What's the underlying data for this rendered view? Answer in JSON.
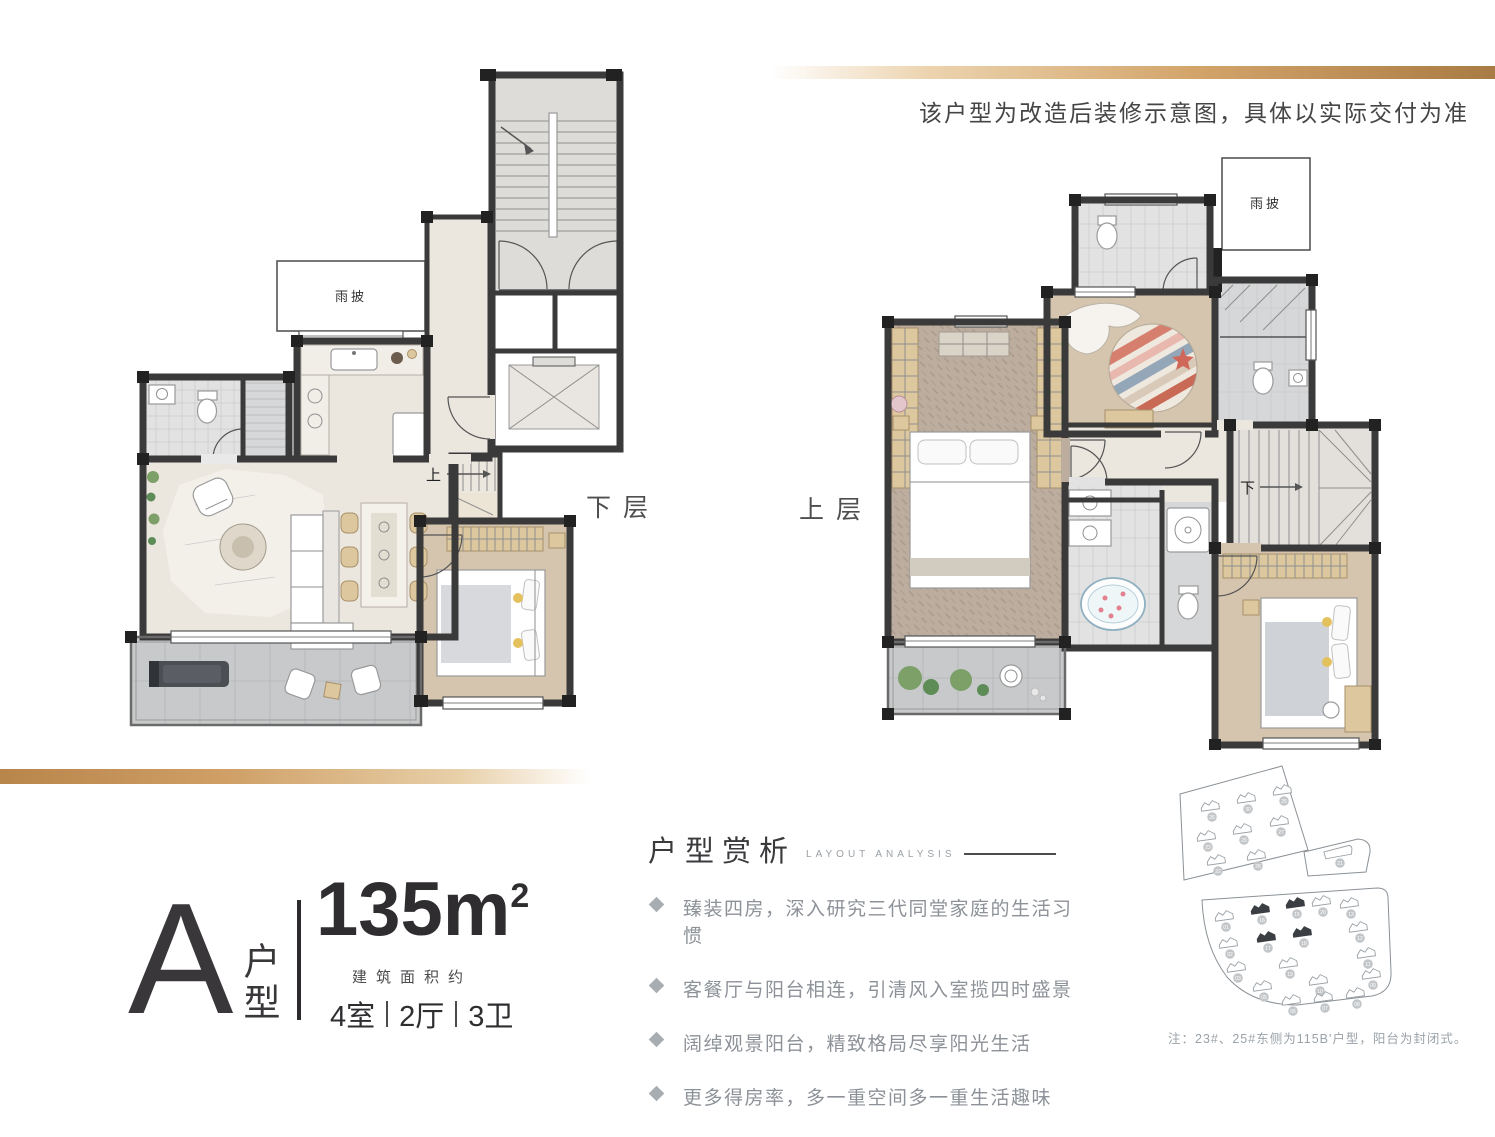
{
  "page": {
    "background": "#ffffff",
    "accent_gold": "#c9995f",
    "wall_color": "#3a3a3a"
  },
  "disclaimer": "该户型为改造后装修示意图，具体以实际交付为准",
  "plans": {
    "lower": {
      "label": "下层",
      "canopy_label": "雨披",
      "stair_label": "上"
    },
    "upper": {
      "label": "上层",
      "canopy_label": "雨披",
      "stair_label": "下"
    }
  },
  "spec": {
    "type_letter": "A",
    "type_name": "户型",
    "area_value": "135m",
    "area_sup": "2",
    "area_caption": "建筑面积约",
    "rooms": [
      "4室",
      "2厅",
      "3卫"
    ]
  },
  "analysis": {
    "title": "户型赏析",
    "subtitle": "LAYOUT ANALYSIS",
    "bullets": [
      "臻装四房，深入研究三代同堂家庭的生活习惯",
      "客餐厅与阳台相连，引清风入室揽四时盛景",
      "阔绰观景阳台，精致格局尽享阳光生活",
      "更多得房率，多一重空间多一重生活趣味"
    ]
  },
  "siteplan": {
    "note": "注：23#、25#东侧为115B'户型，阳台为封闭式。",
    "highlighted": [
      "15",
      "16",
      "17",
      "18"
    ],
    "upper_buildings": [
      "26",
      "30",
      "25",
      "23",
      "29",
      "27",
      "22",
      "28",
      "21"
    ],
    "lower_buildings": [
      "01",
      "16",
      "15",
      "20",
      "13",
      "02",
      "17",
      "18",
      "12",
      "03",
      "19",
      "11",
      "05",
      "10",
      "09",
      "06",
      "07",
      "08"
    ]
  }
}
